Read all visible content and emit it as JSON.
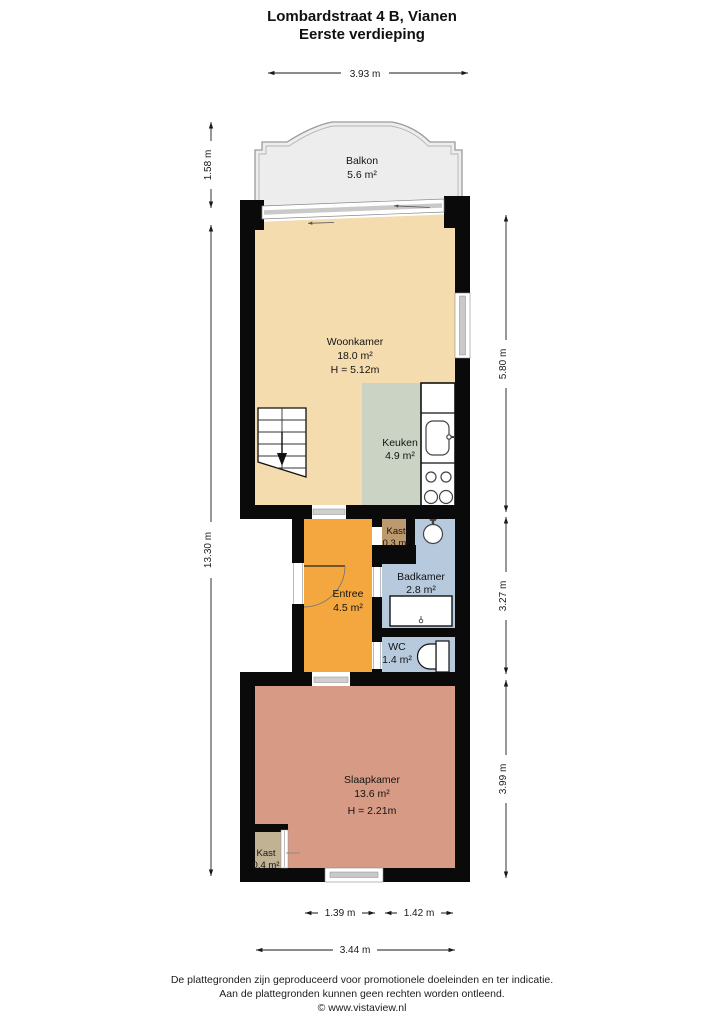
{
  "title": {
    "line1": "Lombardstraat 4 B, Vianen",
    "line2": "Eerste verdieping"
  },
  "rooms": {
    "balkon": {
      "name": "Balkon",
      "area": "5.6 m²"
    },
    "woonkamer": {
      "name": "Woonkamer",
      "area": "18.0 m²",
      "ceiling": "H = 5.12m"
    },
    "keuken": {
      "name": "Keuken",
      "area": "4.9 m²"
    },
    "kast_boven": {
      "name": "Kast",
      "area": "0.3 m²"
    },
    "badkamer": {
      "name": "Badkamer",
      "area": "2.8 m²"
    },
    "entree": {
      "name": "Entree",
      "area": "4.5 m²"
    },
    "wc": {
      "name": "WC",
      "area": "1.4 m²"
    },
    "slaapkamer": {
      "name": "Slaapkamer",
      "area": "13.6 m²",
      "ceiling": "H = 2.21m"
    },
    "kast_onder": {
      "name": "Kast",
      "area": "0.4 m²"
    }
  },
  "dimensions": {
    "top_width": "3.93 m",
    "balkon_depth": "1.58 m",
    "total_height": "13.30 m",
    "right_upper": "5.80 m",
    "right_middle": "3.27 m",
    "right_lower": "3.99 m",
    "bottom_left": "1.39 m",
    "bottom_right": "1.42 m",
    "bottom_total": "3.44 m"
  },
  "colors": {
    "woonkamer": "#f5dcae",
    "keuken": "#cbd3c4",
    "entree": "#f5a73f",
    "badkamer": "#b7c9dd",
    "wc": "#b7c9dd",
    "slaapkamer": "#d79a84",
    "kast_boven": "#bd9a6d",
    "kast_onder": "#c2b294",
    "balkon": "#ededed",
    "wall": "#0a0a0a"
  },
  "footer": {
    "line1": "De plattegronden zijn geproduceerd voor promotionele doeleinden en ter indicatie.",
    "line2": "Aan de plattegronden kunnen geen rechten worden ontleend.",
    "line3": "© www.vistaview.nl"
  }
}
